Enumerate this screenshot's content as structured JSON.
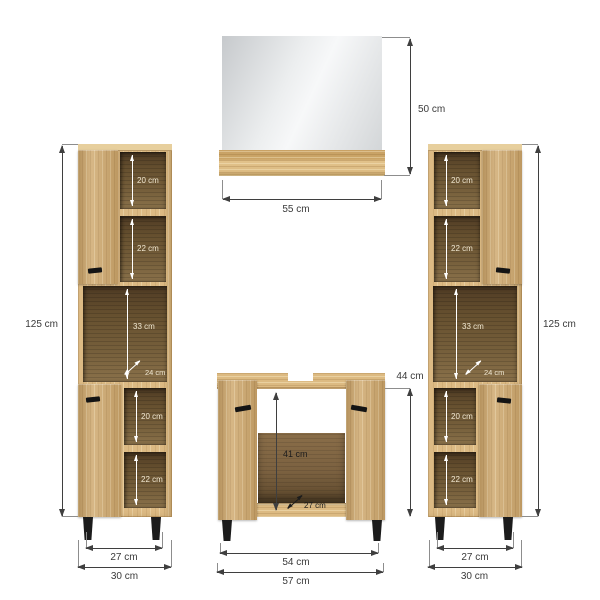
{
  "colors": {
    "wood": "#d3ae74",
    "wood_light": "#e7cf9d",
    "interior_dark": "#5f4a2e",
    "interior_mid": "#7b6240",
    "mirror_gray": "#d6d9db",
    "dimension_line": "#3f3f3f",
    "label_text": "#3a3a3a",
    "white_arrow": "#ffffff",
    "legs_black": "#1c1c1c"
  },
  "mirror": {
    "height_label": "50 cm",
    "width_label": "55 cm"
  },
  "left_cabinet": {
    "height_label": "125 cm",
    "compartments": {
      "top_first": "20 cm",
      "top_second": "22 cm",
      "middle": "33 cm",
      "middle_depth": "24 cm",
      "bottom_first": "20 cm",
      "bottom_second": "22 cm"
    },
    "inner_width_label": "27 cm",
    "outer_width_label": "30 cm"
  },
  "right_cabinet": {
    "height_label": "125 cm",
    "compartments": {
      "top_first": "20 cm",
      "top_second": "22 cm",
      "middle": "33 cm",
      "middle_depth": "24 cm",
      "bottom_first": "20 cm",
      "bottom_second": "22 cm"
    },
    "inner_width_label": "27 cm",
    "outer_width_label": "30 cm"
  },
  "vanity": {
    "height_label": "44 cm",
    "inner_height_label": "41 cm",
    "depth_label": "27 cm",
    "inner_width_label": "54 cm",
    "outer_width_label": "57 cm"
  }
}
